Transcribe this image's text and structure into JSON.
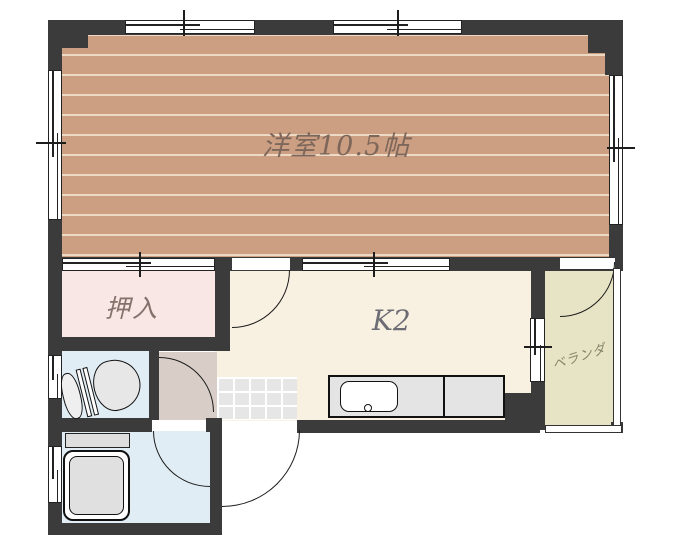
{
  "plan": {
    "type": "apartment-floorplan",
    "rooms": {
      "western_room": {
        "label": "洋室10.5帖"
      },
      "closet": {
        "label": "押入"
      },
      "kitchen": {
        "label": "K2"
      },
      "veranda": {
        "label": "ベランダ"
      }
    },
    "fixtures": [
      "toilet",
      "bathtub",
      "bath-shelf",
      "kitchen-counter",
      "kitchen-sink",
      "genkan-tiles",
      "veranda-railing"
    ],
    "colors": {
      "wall": "#3b3b3b",
      "wood_floor": "#cd9f82",
      "wood_stripe": "#eed9c4",
      "closet_pink": "#f8e7e4",
      "kitchen_cream": "#f8f0e1",
      "hall_beige": "#d8cec7",
      "wet_room_blue": "#e1edf5",
      "veranda_khaki": "#e6e4c4",
      "tile_gray": "#e6e6e6",
      "label_brown": "#7d675b"
    }
  }
}
